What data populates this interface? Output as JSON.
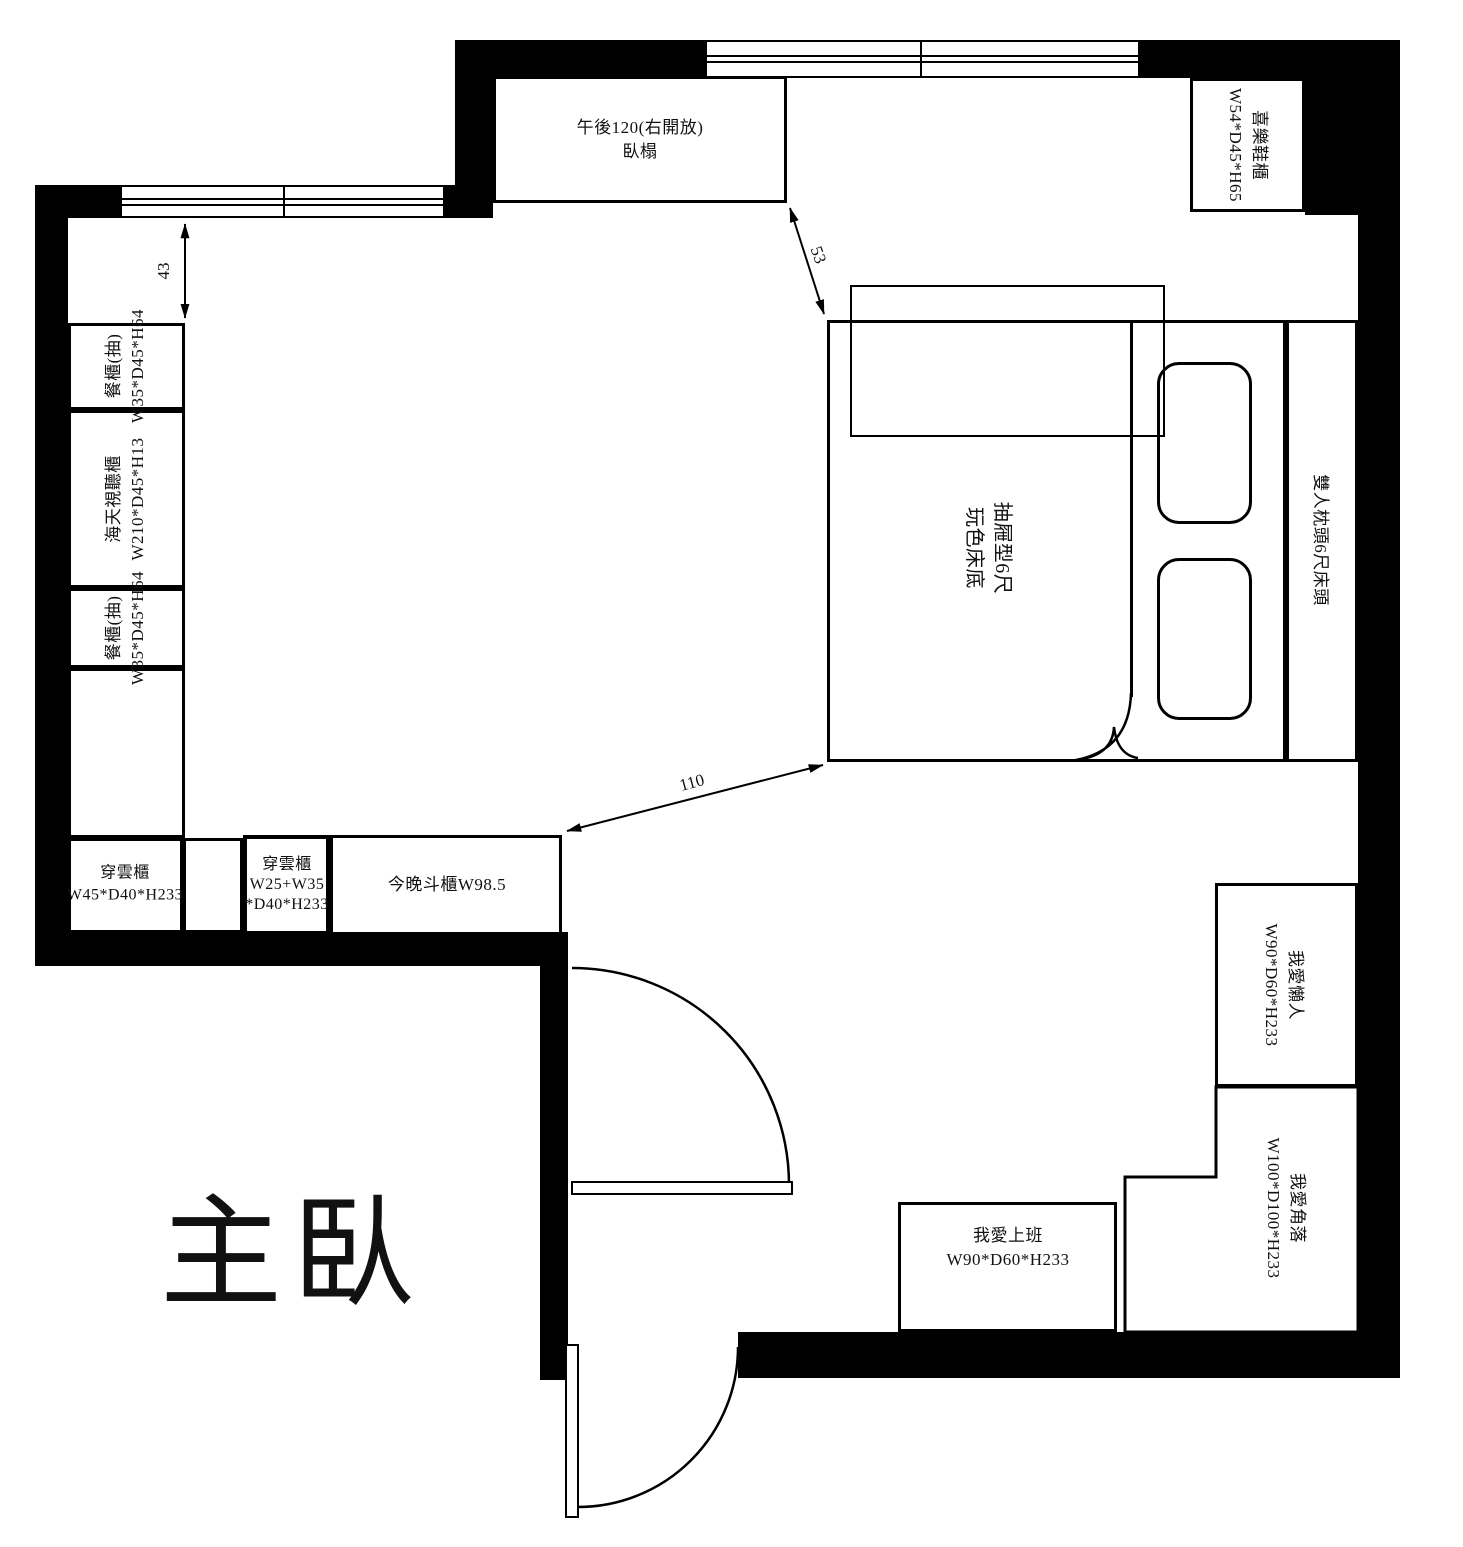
{
  "title": "主臥",
  "furniture": {
    "daybed": {
      "line1": "午後120(右開放)",
      "line2": "臥榻"
    },
    "shoe_cabinet": {
      "name": "喜樂鞋櫃",
      "dims": "W54*D45*H65"
    },
    "dining_cabinet_top": {
      "name": "餐櫃(抽)",
      "dims": "W35*D45*H64"
    },
    "av_cabinet": {
      "name": "海天視聽櫃",
      "dims": "W210*D45*H13"
    },
    "dining_cabinet_bottom": {
      "name": "餐櫃(抽)",
      "dims": "W35*D45*H64"
    },
    "wardrobe_left": {
      "name": "穿雲櫃",
      "dims": "W45*D40*H233"
    },
    "wardrobe_small": {
      "name": "穿雲櫃",
      "dims_line1": "W25+W35",
      "dims_line2": "*D40*H233"
    },
    "chest": {
      "name": "今晚斗櫃W98.5"
    },
    "bed": {
      "line1": "抽屜型6尺",
      "line2": "玩色床底"
    },
    "headboard": {
      "name": "雙人枕頭6尺床頭"
    },
    "lazy_unit": {
      "name": "我愛懶人",
      "dims": "W90*D60*H233"
    },
    "corner_unit": {
      "name": "我愛角落",
      "dims": "W100*D100*H233"
    },
    "desk": {
      "name": "我愛上班",
      "dims": "W90*D60*H233"
    }
  },
  "dimensions": {
    "d43": "43",
    "d53": "53",
    "d110": "110"
  }
}
